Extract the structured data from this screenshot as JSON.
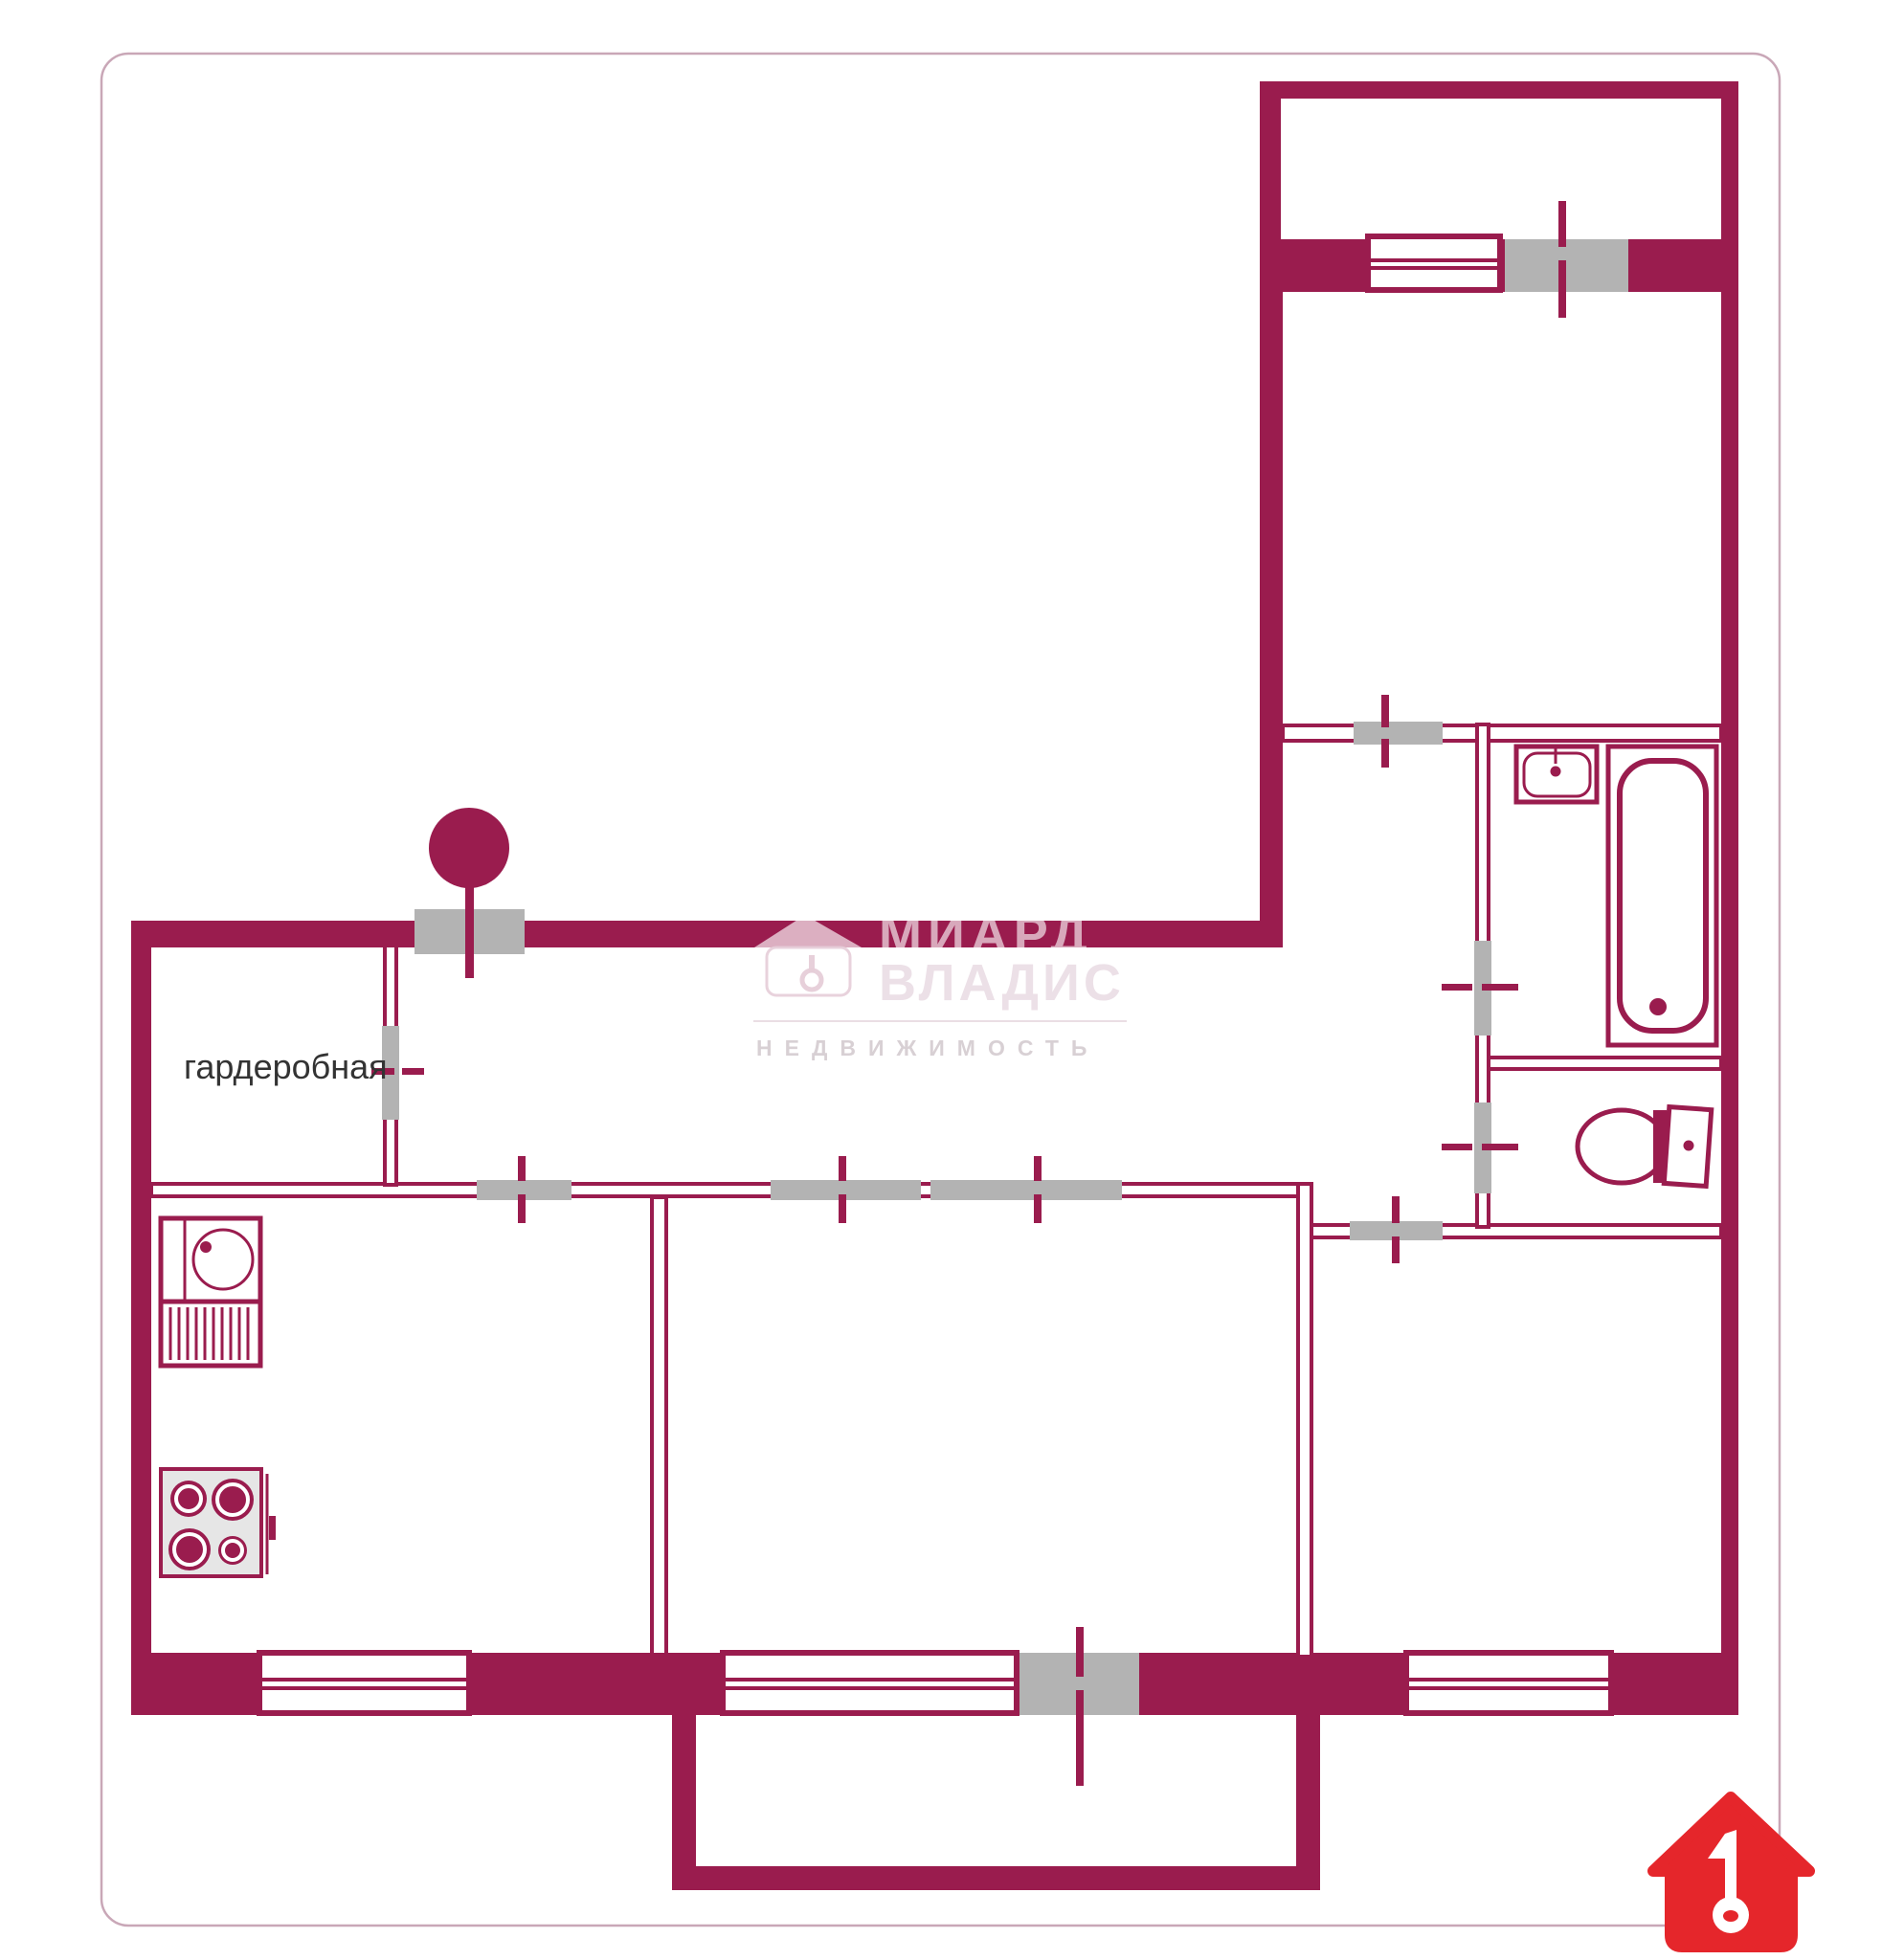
{
  "plan": {
    "labels": {
      "wardrobe": "гардеробная"
    },
    "colors": {
      "wall": "#9a1c4e",
      "door_fill": "#b3b3b3",
      "frame_border": "#c9a7b7",
      "stove_fill": "#e6e6e6",
      "label_text": "#333333",
      "logo_red": "#e5262b"
    },
    "fixtures": [
      "kitchen-sink",
      "drain-board",
      "stove",
      "entry-door-mark",
      "bathroom-sink",
      "bathtub",
      "toilet"
    ]
  },
  "watermark": {
    "brand_top": "МИАРД",
    "brand_bottom": "ВЛАДИС",
    "tagline": "НЕДВИЖИМОСТЬ"
  }
}
